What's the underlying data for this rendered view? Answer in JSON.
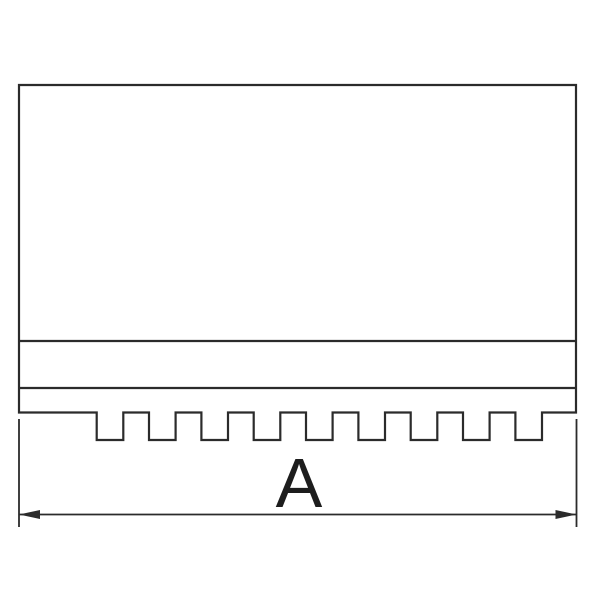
{
  "diagram": {
    "type": "technical-drawing",
    "subject": "chuck-jaw-side-view-with-serrated-base",
    "background_color": "#ffffff",
    "stroke_color": "#2b2b2b",
    "part": {
      "left_x": 19,
      "right_x": 576,
      "top_y": 85,
      "body_bottom_y": 412.5,
      "tooth_bottom_y": 440,
      "divider_lines_y": [
        341,
        388
      ],
      "tooth_down_steps_x": [
        96.7,
        149.0,
        201.4,
        253.7,
        306.0,
        358.4,
        410.7,
        463.0,
        515.4
      ],
      "tooth_up_steps_x": [
        123.3,
        175.6,
        228.0,
        280.3,
        332.6,
        385.0,
        437.3,
        489.6,
        542.0
      ],
      "outline_stroke_width": 2.2
    },
    "dimension": {
      "label": "A",
      "line_y": 514.5,
      "start_x": 19,
      "end_x": 576.5,
      "extension_top_y": 419,
      "extension_bottom_y": 527,
      "arrow_length": 21,
      "arrow_half_height": 4.5,
      "label_center_x": 299,
      "label_baseline_y": 507,
      "label_font_size": 70,
      "stroke_width": 1.8
    }
  }
}
